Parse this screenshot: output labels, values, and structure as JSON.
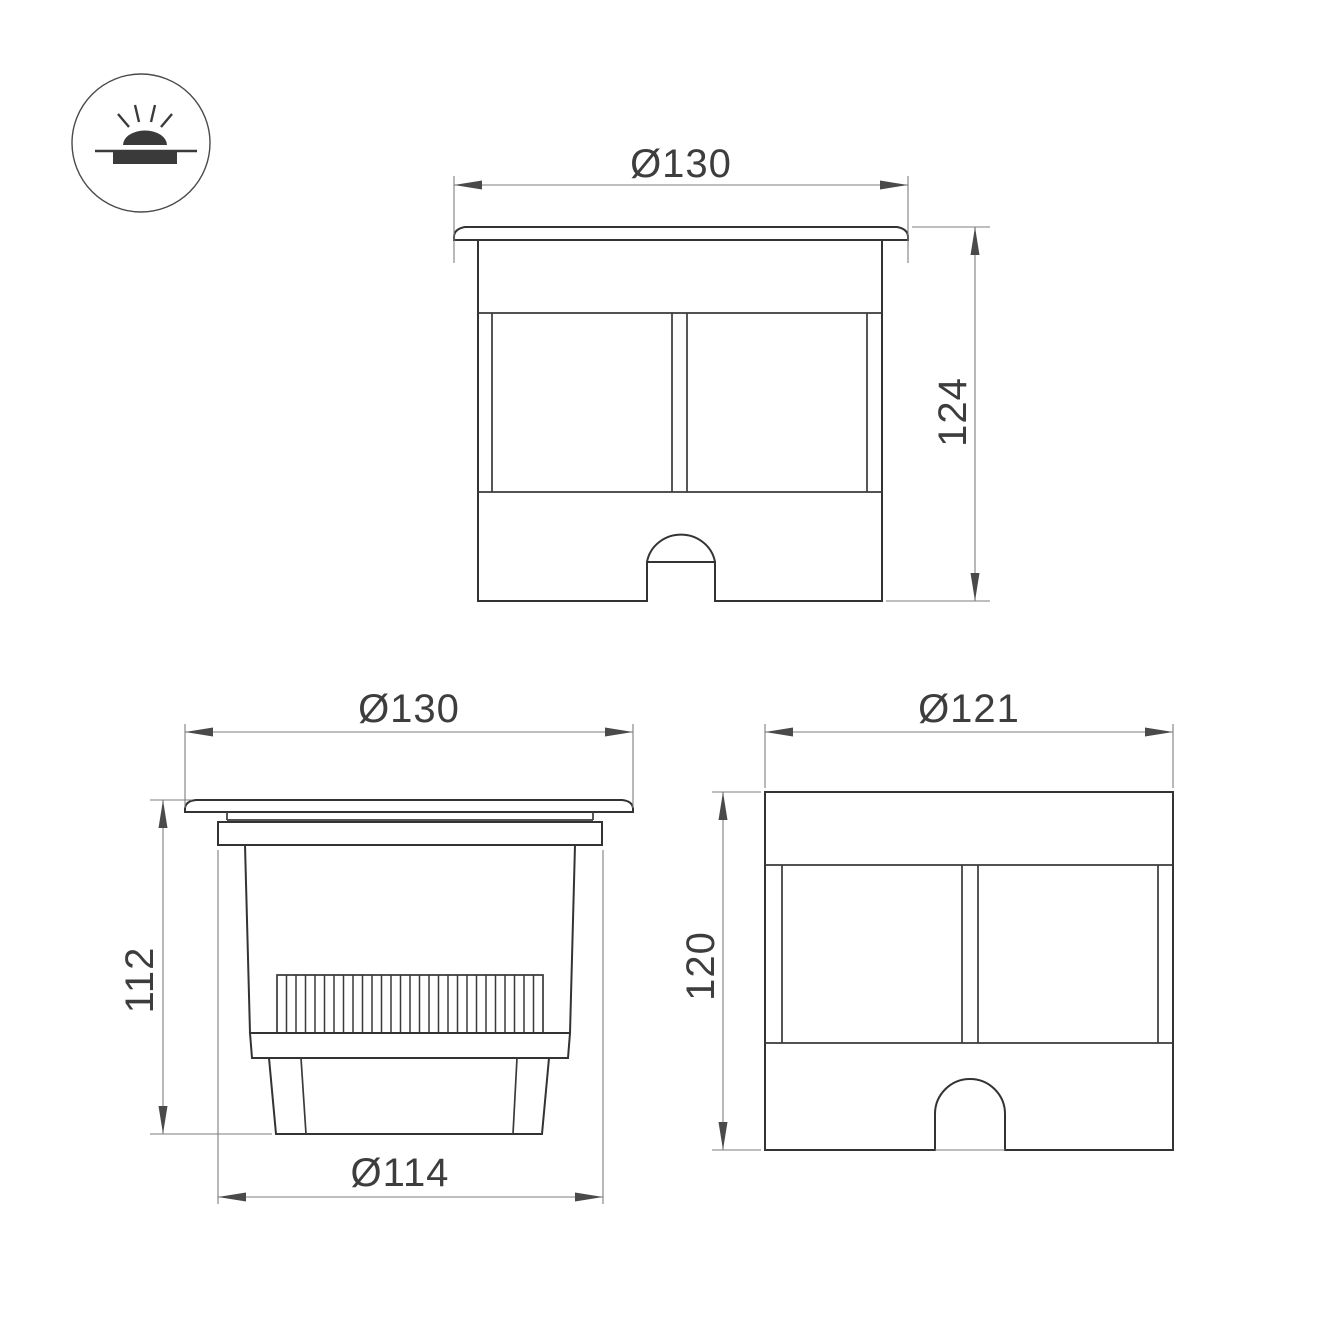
{
  "icon": {
    "name": "recessed-ground-light-icon"
  },
  "views": {
    "front": {
      "width_label": "Ø130",
      "height_label": "124"
    },
    "side": {
      "width_label": "Ø130",
      "height_label": "112",
      "base_width_label": "Ø114"
    },
    "rear": {
      "width_label": "Ø121",
      "height_label": "120"
    }
  },
  "colors": {
    "background": "#ffffff",
    "object_line": "#333333",
    "dimension_line": "#7d7d7d",
    "text": "#3d3d3d"
  }
}
